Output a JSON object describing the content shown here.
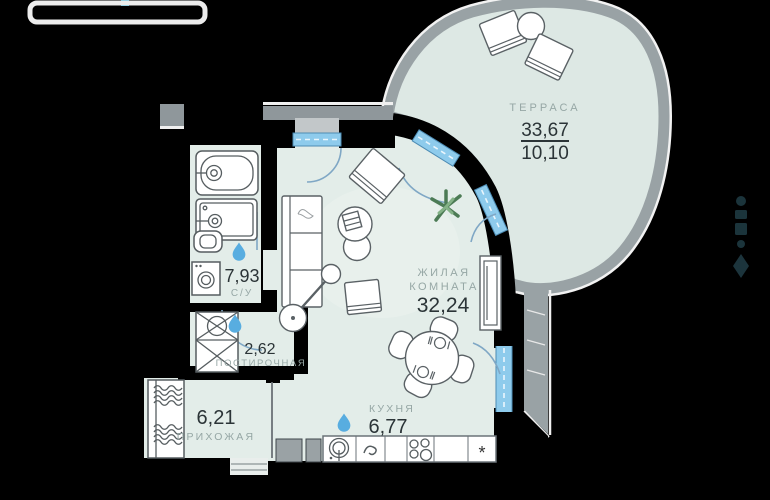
{
  "floorplan": {
    "rooms": {
      "terrace": {
        "label": "ТЕРРАСА",
        "area_total": "33,67",
        "area_reduced": "10,10"
      },
      "living": {
        "label_line1": "ЖИЛАЯ",
        "label_line2": "КОМНАТА",
        "area": "32,24"
      },
      "bathroom": {
        "label": "С/У",
        "area": "7,93"
      },
      "laundry": {
        "label": "ПОСТИРОЧНАЯ",
        "area": "2,62"
      },
      "hallway": {
        "label": "ПРИХОЖАЯ",
        "area": "6,21"
      },
      "kitchen": {
        "label": "КУХНЯ",
        "area": "6,77"
      }
    },
    "kitchen_symbols": {
      "freezer": "*"
    },
    "icons": [
      "water-drop-icon",
      "plant-icon",
      "developer-watermark-icon",
      "hanger-waves-icon"
    ],
    "colors": {
      "room_fill": "#e3ede9",
      "terrace_fill": "#dde8e4",
      "wall": "#000000",
      "exterior_band": "#99a2a5",
      "window_blue": "#8ecbec",
      "water_drop_blue": "#58ade0",
      "number_text": "#2b3437",
      "label_text": "#96a7a5"
    }
  }
}
